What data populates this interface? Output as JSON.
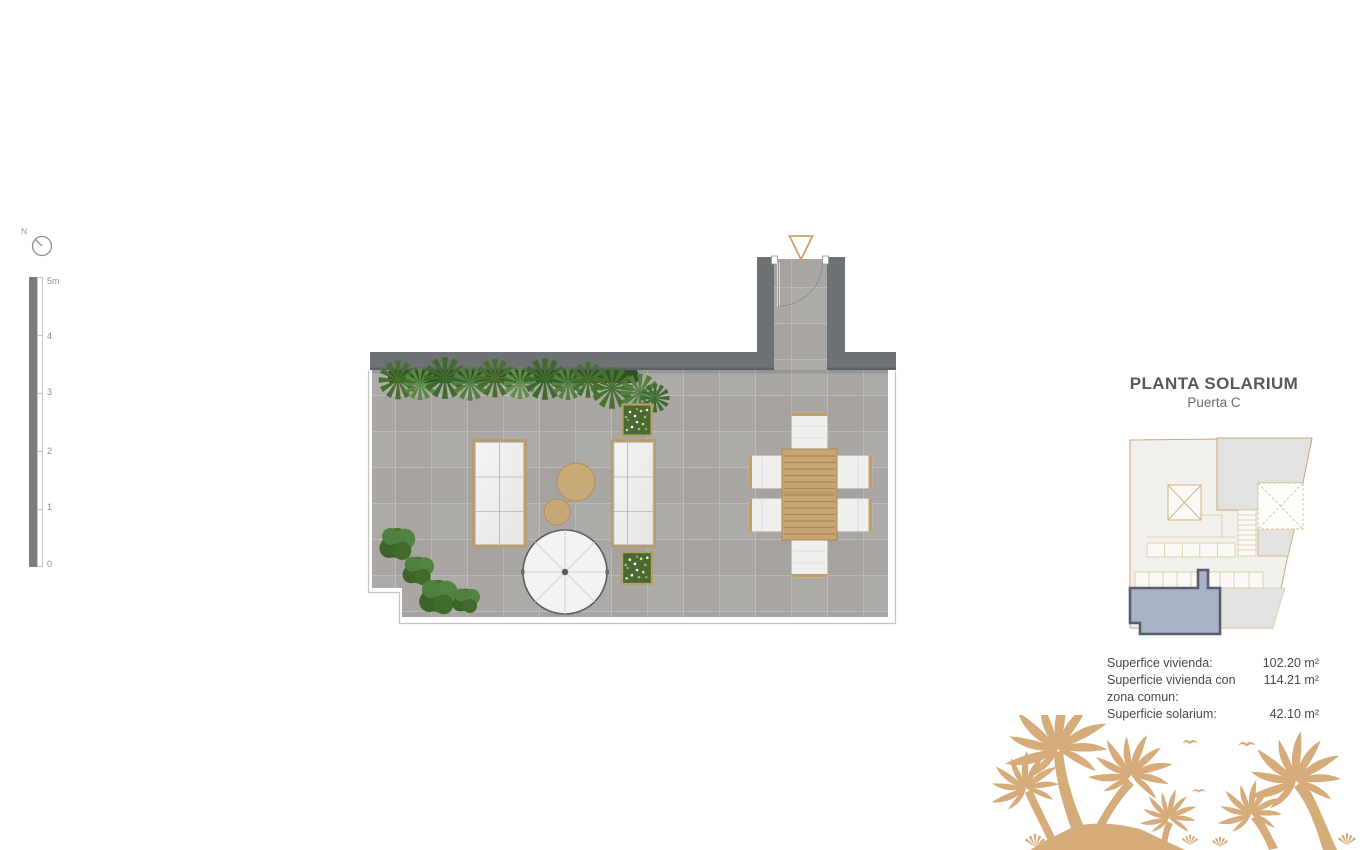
{
  "colors": {
    "background": "#ffffff",
    "wall": "#6e7274",
    "tile": "#a9a6a3",
    "tile_grid": "#bcb9b6",
    "wood": "#c8a672",
    "frame_tan": "#b99c72",
    "accent_outline": "#cfa265",
    "hedge_dark": "#2f5023",
    "green_mid": "#538340",
    "palm_sand": "#d7ac7b",
    "keyplan_line": "#cda875",
    "keyplan_gray": "#e2e2e0",
    "highlight_fill": "#a9b1c5",
    "highlight_stroke": "#565e6f",
    "title_text": "#57585a",
    "body_text": "#48494b"
  },
  "compass": {
    "north_label": "N"
  },
  "scale_bar": {
    "labels": [
      "5m",
      "4",
      "3",
      "2",
      "1",
      "0"
    ]
  },
  "panel": {
    "title": "PLANTA SOLARIUM",
    "subtitle": "Puerta C",
    "areas": [
      {
        "label": "Superfice vivienda:",
        "value": "102.20 m²"
      },
      {
        "label": "Superficie vivienda con zona comun:",
        "value": "114.21 m²"
      },
      {
        "label": "Superficie solarium:",
        "value": "42.10 m²"
      }
    ]
  }
}
